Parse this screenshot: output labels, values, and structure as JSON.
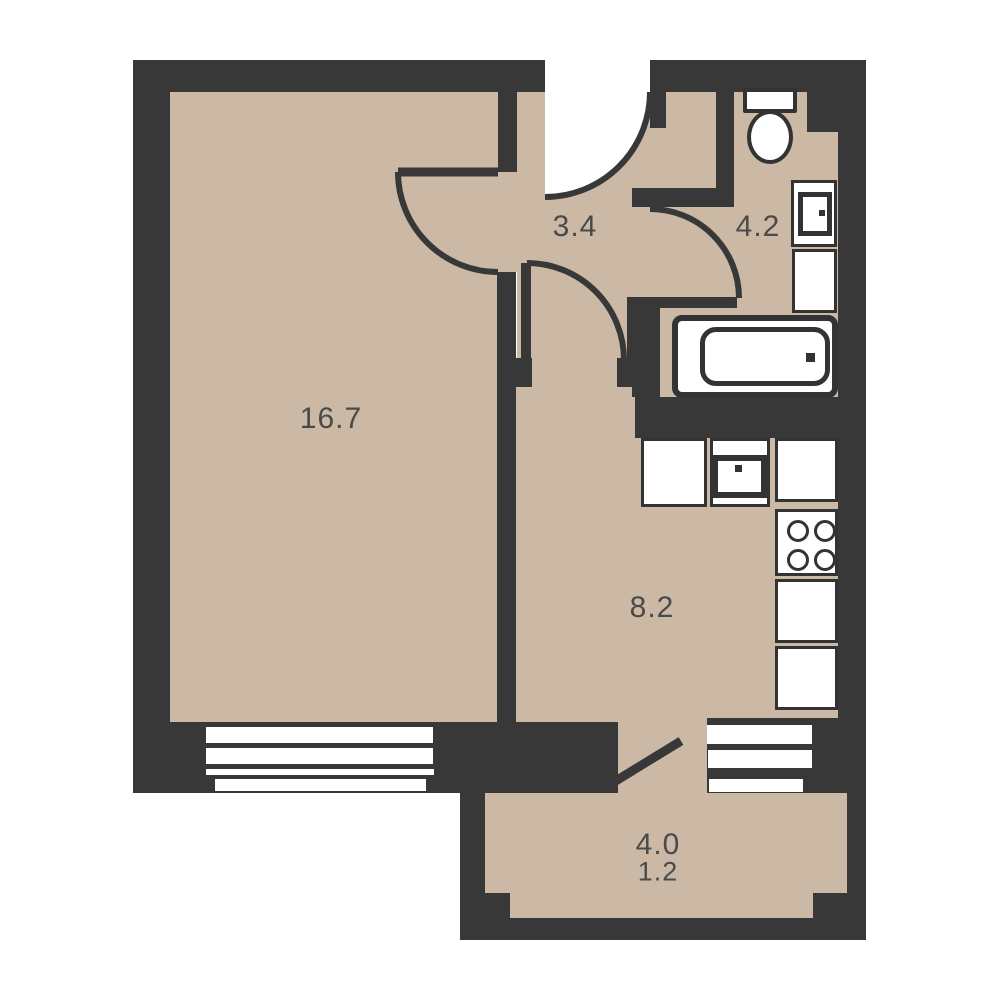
{
  "plan": {
    "title": "apartment-floor-plan",
    "colors": {
      "background": "#ffffff",
      "wall": "#383838",
      "floor": "#cbb9a5",
      "fixture_stroke": "#333333",
      "label_text": "#4a4a4a"
    },
    "rooms": [
      {
        "name": "living-room",
        "area": "16.7"
      },
      {
        "name": "hallway",
        "area": "3.4"
      },
      {
        "name": "bathroom",
        "area": "4.2"
      },
      {
        "name": "kitchen",
        "area": "8.2"
      },
      {
        "name": "balcony-full",
        "area": "4.0"
      },
      {
        "name": "balcony-reduced",
        "area": "1.2"
      }
    ],
    "fixtures": [
      "toilet",
      "washbasin",
      "bathroom-cabinet",
      "bathtub",
      "kitchen-counter",
      "kitchen-sink",
      "stove-4-burners",
      "window-living-room",
      "window-kitchen",
      "entrance-door",
      "room-door",
      "kitchen-door",
      "bathroom-door",
      "balcony-door"
    ]
  }
}
